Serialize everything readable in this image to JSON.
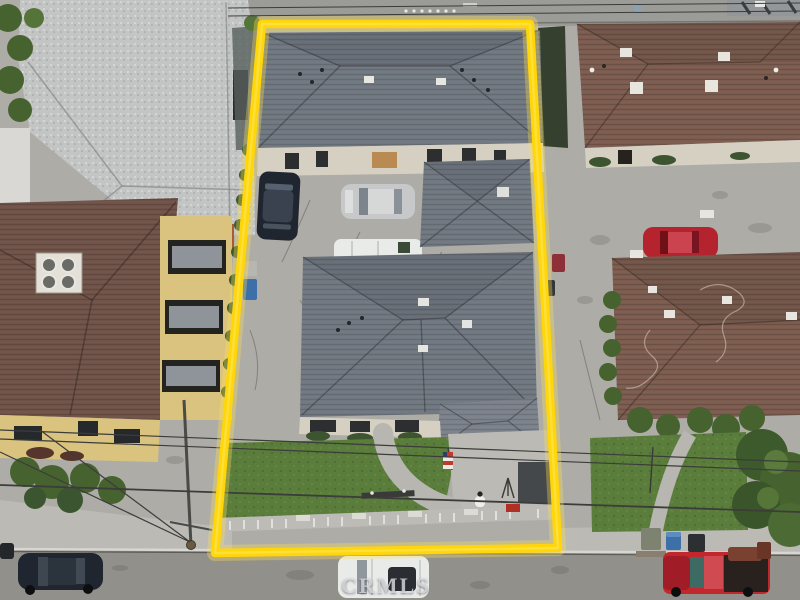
{
  "meta": {
    "type": "aerial-drone-photo",
    "description": "Top-down aerial photograph of a residential lot outlined in yellow, flanked by neighboring houses, driveways and a street at the bottom"
  },
  "watermark": {
    "text": "CRMLS"
  },
  "boundary": {
    "shape": "trapezoid",
    "color": "#FFD60A"
  },
  "palette": {
    "boundary_yellow": "#FFD60A",
    "boundary_glow": "#FFDF4D",
    "roof_gray": "#6F767F",
    "roof_gray_light": "#7A818A",
    "roof_light": "#C2C5C4",
    "roof_brown": "#7A5B4E",
    "roof_brown2": "#6E5147",
    "wall_cream": "#D6D0C2",
    "wall_yellow": "#D9C37F",
    "grass": "#5A7D3C",
    "tree_green": "#46622F",
    "concrete": "#AEACA7",
    "concrete_light": "#BCBAB4",
    "asphalt": "#92908A",
    "alley_gray": "#9B9B97",
    "car_dark": "#1F2630",
    "car_silver": "#C6C8C9",
    "car_white": "#E9EBE9",
    "car_red": "#B5242E",
    "truck_red": "#C1272D",
    "bin_blue": "#3D6FA8"
  },
  "objects": [
    {
      "name": "property-boundary",
      "label": "yellow lot outline"
    },
    {
      "name": "rear-house-roof",
      "label": "gray hip roof (rear unit)"
    },
    {
      "name": "detached-garage-roof",
      "label": "gray pyramid garage roof"
    },
    {
      "name": "main-house-roof",
      "label": "gray cross-hip main house roof"
    },
    {
      "name": "dark-car",
      "label": "dark sedan in courtyard"
    },
    {
      "name": "silver-sedan",
      "label": "silver sedan in courtyard"
    },
    {
      "name": "white-van",
      "label": "white van in driveway"
    },
    {
      "name": "front-lawn",
      "label": "front lawn with curved walkway"
    },
    {
      "name": "front-fence",
      "label": "low concrete baluster fence"
    },
    {
      "name": "american-flag",
      "label": "flag at porch"
    },
    {
      "name": "person",
      "label": "person near front fence"
    },
    {
      "name": "top-left-house-roof",
      "label": "light gray shingle roof"
    },
    {
      "name": "apartment-building",
      "label": "brown roof apartment with balconies"
    },
    {
      "name": "neighbor-house-north-roof",
      "label": "brown hip roof (upper right)"
    },
    {
      "name": "neighbor-house-south-roof",
      "label": "brown hip roof (lower right)"
    },
    {
      "name": "red-car",
      "label": "red car in neighbor driveway"
    },
    {
      "name": "black-car",
      "label": "black car parked on street"
    },
    {
      "name": "white-suv",
      "label": "white SUV parked on street"
    },
    {
      "name": "red-pickup-truck",
      "label": "red pickup with furniture in bed"
    },
    {
      "name": "trash-bins",
      "label": "curbside trash bins"
    },
    {
      "name": "utility-pole",
      "label": "utility pole with shadow"
    },
    {
      "name": "power-lines",
      "label": "overhead power lines"
    },
    {
      "name": "street-tree",
      "label": "large tree at lower right"
    },
    {
      "name": "crmls-watermark",
      "label": "CRMLS watermark text"
    }
  ]
}
